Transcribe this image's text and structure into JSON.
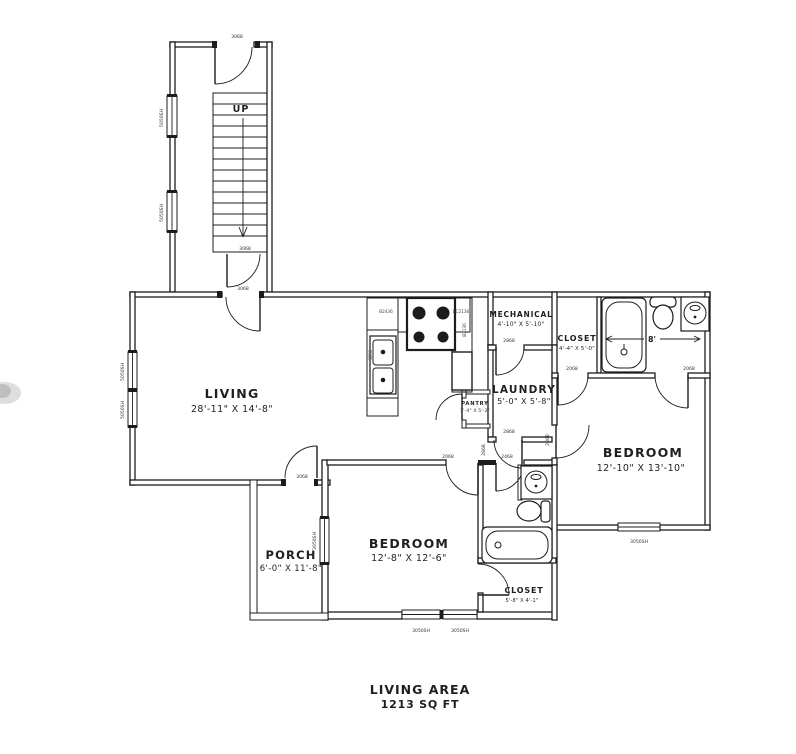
{
  "plan_title": {
    "line1": "LIVING AREA",
    "line2": "1213 SQ FT"
  },
  "rooms": {
    "living": {
      "name": "LIVING",
      "dims": "28'-11\" X 14'-8\""
    },
    "bedroom_right": {
      "name": "BEDROOM",
      "dims": "12'-10\" X 13'-10\""
    },
    "bedroom_bottom": {
      "name": "BEDROOM",
      "dims": "12'-8\" X 12'-6\""
    },
    "porch": {
      "name": "PORCH",
      "dims": "6'-0\" X 11'-8\""
    },
    "laundry": {
      "name": "LAUNDRY",
      "dims": "5'-0\" X 5'-8\""
    },
    "mechanical": {
      "name": "MECHANICAL",
      "dims": "4'-10\" X 5'-10\""
    },
    "closet_top": {
      "name": "CLOSET",
      "dims": "4'-4\" X 5'-0\""
    },
    "closet_bottom": {
      "name": "CLOSET",
      "dims": "5'-8\" X 4'-1\""
    },
    "pantry": {
      "name": "PANTRY",
      "dims": "1'-4\" X 5'-2\""
    }
  },
  "stairs": {
    "direction_label": "UP"
  },
  "dimension_labels": {
    "bath_width": "8'"
  },
  "door_size_labels": {
    "entry_top": "3068",
    "stair_bottom": "3068",
    "living_entry": "3068",
    "porch": "3068",
    "mechanical": "2868",
    "laundry": "2868",
    "hall_left": "2068",
    "hall_right": "2468",
    "closet_top": "2068",
    "bath_top": "2068",
    "bedroom_right_entry": "2868",
    "bathroom_mid_entry": "2868"
  },
  "window_size_labels": {
    "stair_upper": "5050SH",
    "stair_lower": "5050SH",
    "living_upper": "5050SH",
    "living_lower": "5050SH",
    "porch_side": "3050SH",
    "bedroom_bottom_left": "3050SH",
    "bedroom_bottom_right": "3050SH",
    "bedroom_right": "3050SH"
  },
  "cabinet_labels": {
    "left": "B2436",
    "right": "BC2136",
    "side_left": "SB36",
    "side_right": "B2136"
  },
  "colors": {
    "line": "#1c1c1c",
    "text": "#1f1f1f",
    "paper": "#ffffff"
  }
}
